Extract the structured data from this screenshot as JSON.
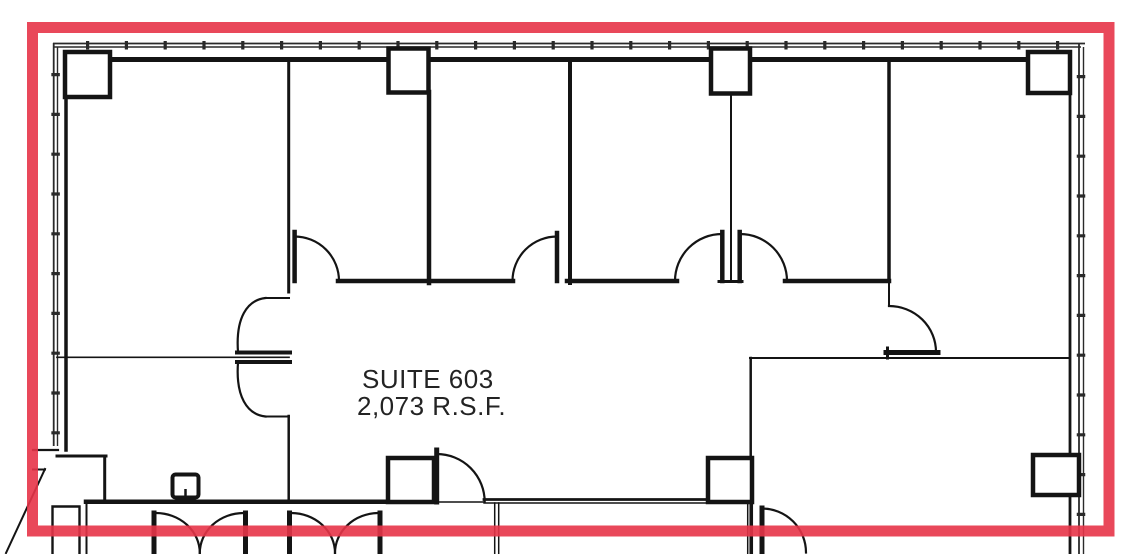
{
  "plan": {
    "suite_label": "SUITE 603",
    "area_label": "2,073 R.S.F.",
    "highlight_color": "#e73448",
    "wall_color": "#141414",
    "glass_color": "#2a2a2a",
    "text_color": "#232323"
  }
}
